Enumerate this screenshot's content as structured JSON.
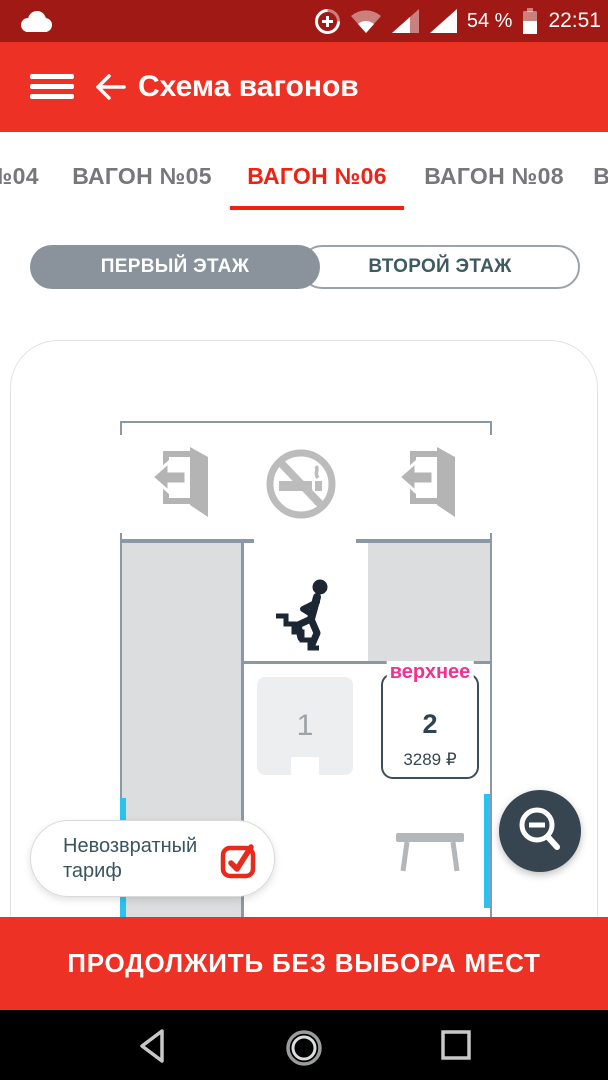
{
  "status_bar": {
    "battery_percent": "54 %",
    "time": "22:51",
    "icons": [
      "cloud",
      "data-saver",
      "wifi",
      "cell-signal-1",
      "cell-signal-2",
      "battery"
    ]
  },
  "app_bar": {
    "title": "Схема вагонов",
    "icons": [
      "menu",
      "back-arrow"
    ]
  },
  "tabs": {
    "items": [
      {
        "label": "ВАГОН №04",
        "selected": false
      },
      {
        "label": "ВАГОН №05",
        "selected": false
      },
      {
        "label": "ВАГОН №06",
        "selected": true
      },
      {
        "label": "ВАГОН №08",
        "selected": false
      },
      {
        "label": "ВАГОН №09",
        "selected": false
      }
    ]
  },
  "floor_toggle": {
    "options": [
      {
        "label": "ПЕРВЫЙ ЭТАЖ",
        "selected": true
      },
      {
        "label": "ВТОРОЙ ЭТАЖ",
        "selected": false
      }
    ]
  },
  "car_scheme": {
    "icons": [
      "exit-door-left",
      "no-smoking",
      "exit-door-right",
      "stairs-person",
      "table"
    ],
    "seats": [
      {
        "number": "1",
        "status": "unavailable"
      },
      {
        "number": "2",
        "type": "верхнее",
        "price": "3289 ₽",
        "status": "available"
      }
    ]
  },
  "tariff_chip": {
    "label": "Невозвратный тариф",
    "checked": true
  },
  "map_controls": {
    "zoom_out": "zoom-out-magnifier"
  },
  "continue_button": {
    "label": "ПРОДОЛЖИТЬ БЕЗ ВЫБОРА МЕСТ"
  },
  "nav_bar": {
    "icons": [
      "back-triangle",
      "home-circle",
      "recents-square"
    ]
  },
  "colors": {
    "primary_red": "#ED3124",
    "status_bar_red": "#A01915",
    "tab_active_red": "#ED2213",
    "upper_berth_pink": "#F5308F",
    "available_cyan": "#2BC2EF",
    "dark_slate": "#36454F",
    "checkbox_red": "#E8291B",
    "wall_slate": "#8A99A5"
  }
}
